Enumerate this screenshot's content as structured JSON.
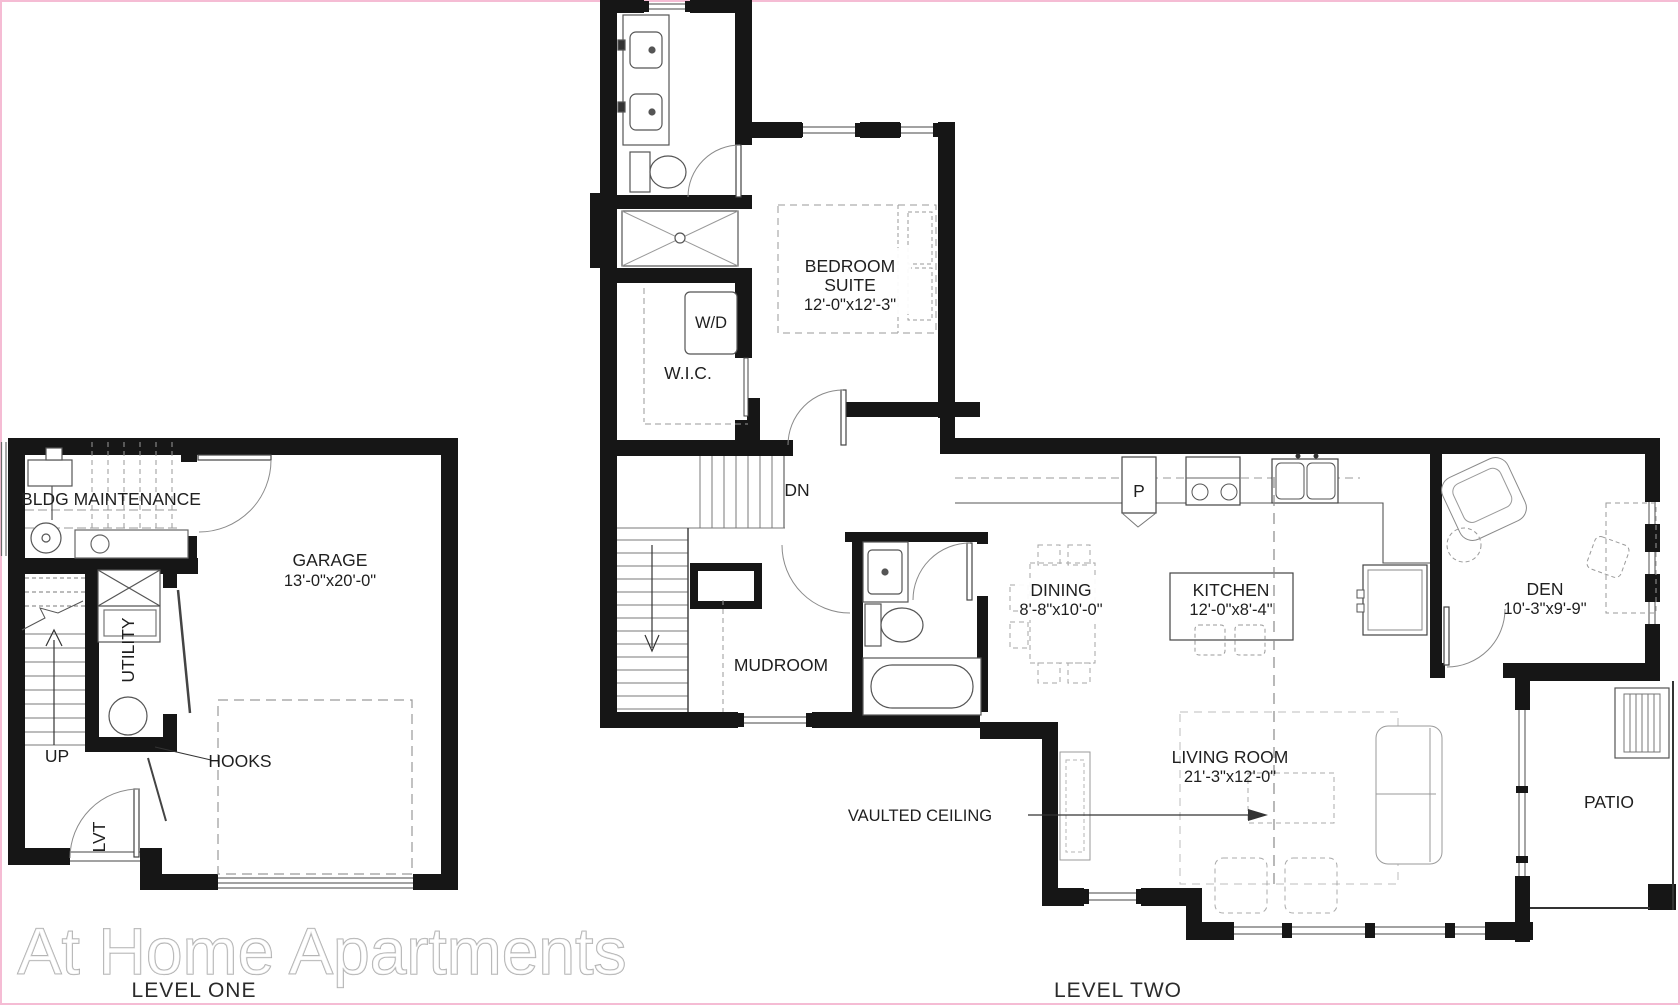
{
  "watermark": "At Home Apartments",
  "level_one": {
    "title": "LEVEL ONE",
    "labels": {
      "bldg_maintenance": "BLDG MAINTENANCE",
      "garage": "GARAGE",
      "garage_dims": "13'-0\"x20'-0\"",
      "utility": "UTILITY",
      "up": "UP",
      "hooks": "HOOKS",
      "lvt": "LVT"
    }
  },
  "level_two": {
    "title": "LEVEL TWO",
    "labels": {
      "bedroom_line1": "BEDROOM",
      "bedroom_line2": "SUITE",
      "bedroom_dims": "12'-0\"x12'-3\"",
      "wd": "W/D",
      "wic": "W.I.C.",
      "dn": "DN",
      "mudroom": "MUDROOM",
      "dining": "DINING",
      "dining_dims": "8'-8\"x10'-0\"",
      "kitchen": "KITCHEN",
      "kitchen_dims": "12'-0\"x8'-4\"",
      "pantry": "P",
      "den": "DEN",
      "den_dims": "10'-3\"x9'-9\"",
      "living_room": "LIVING ROOM",
      "living_room_dims": "21'-3\"x12'-0\"",
      "vaulted_ceiling": "VAULTED CEILING",
      "patio": "PATIO"
    }
  },
  "colors": {
    "wall": "#161616",
    "fixture_line": "#4a4a4a",
    "light_line": "#8a8a8a",
    "dashed_line": "#9a9a9a",
    "text": "#1f1f1f",
    "edge_border": "#f5bcd4",
    "watermark_stroke": "#a8a8a8"
  }
}
